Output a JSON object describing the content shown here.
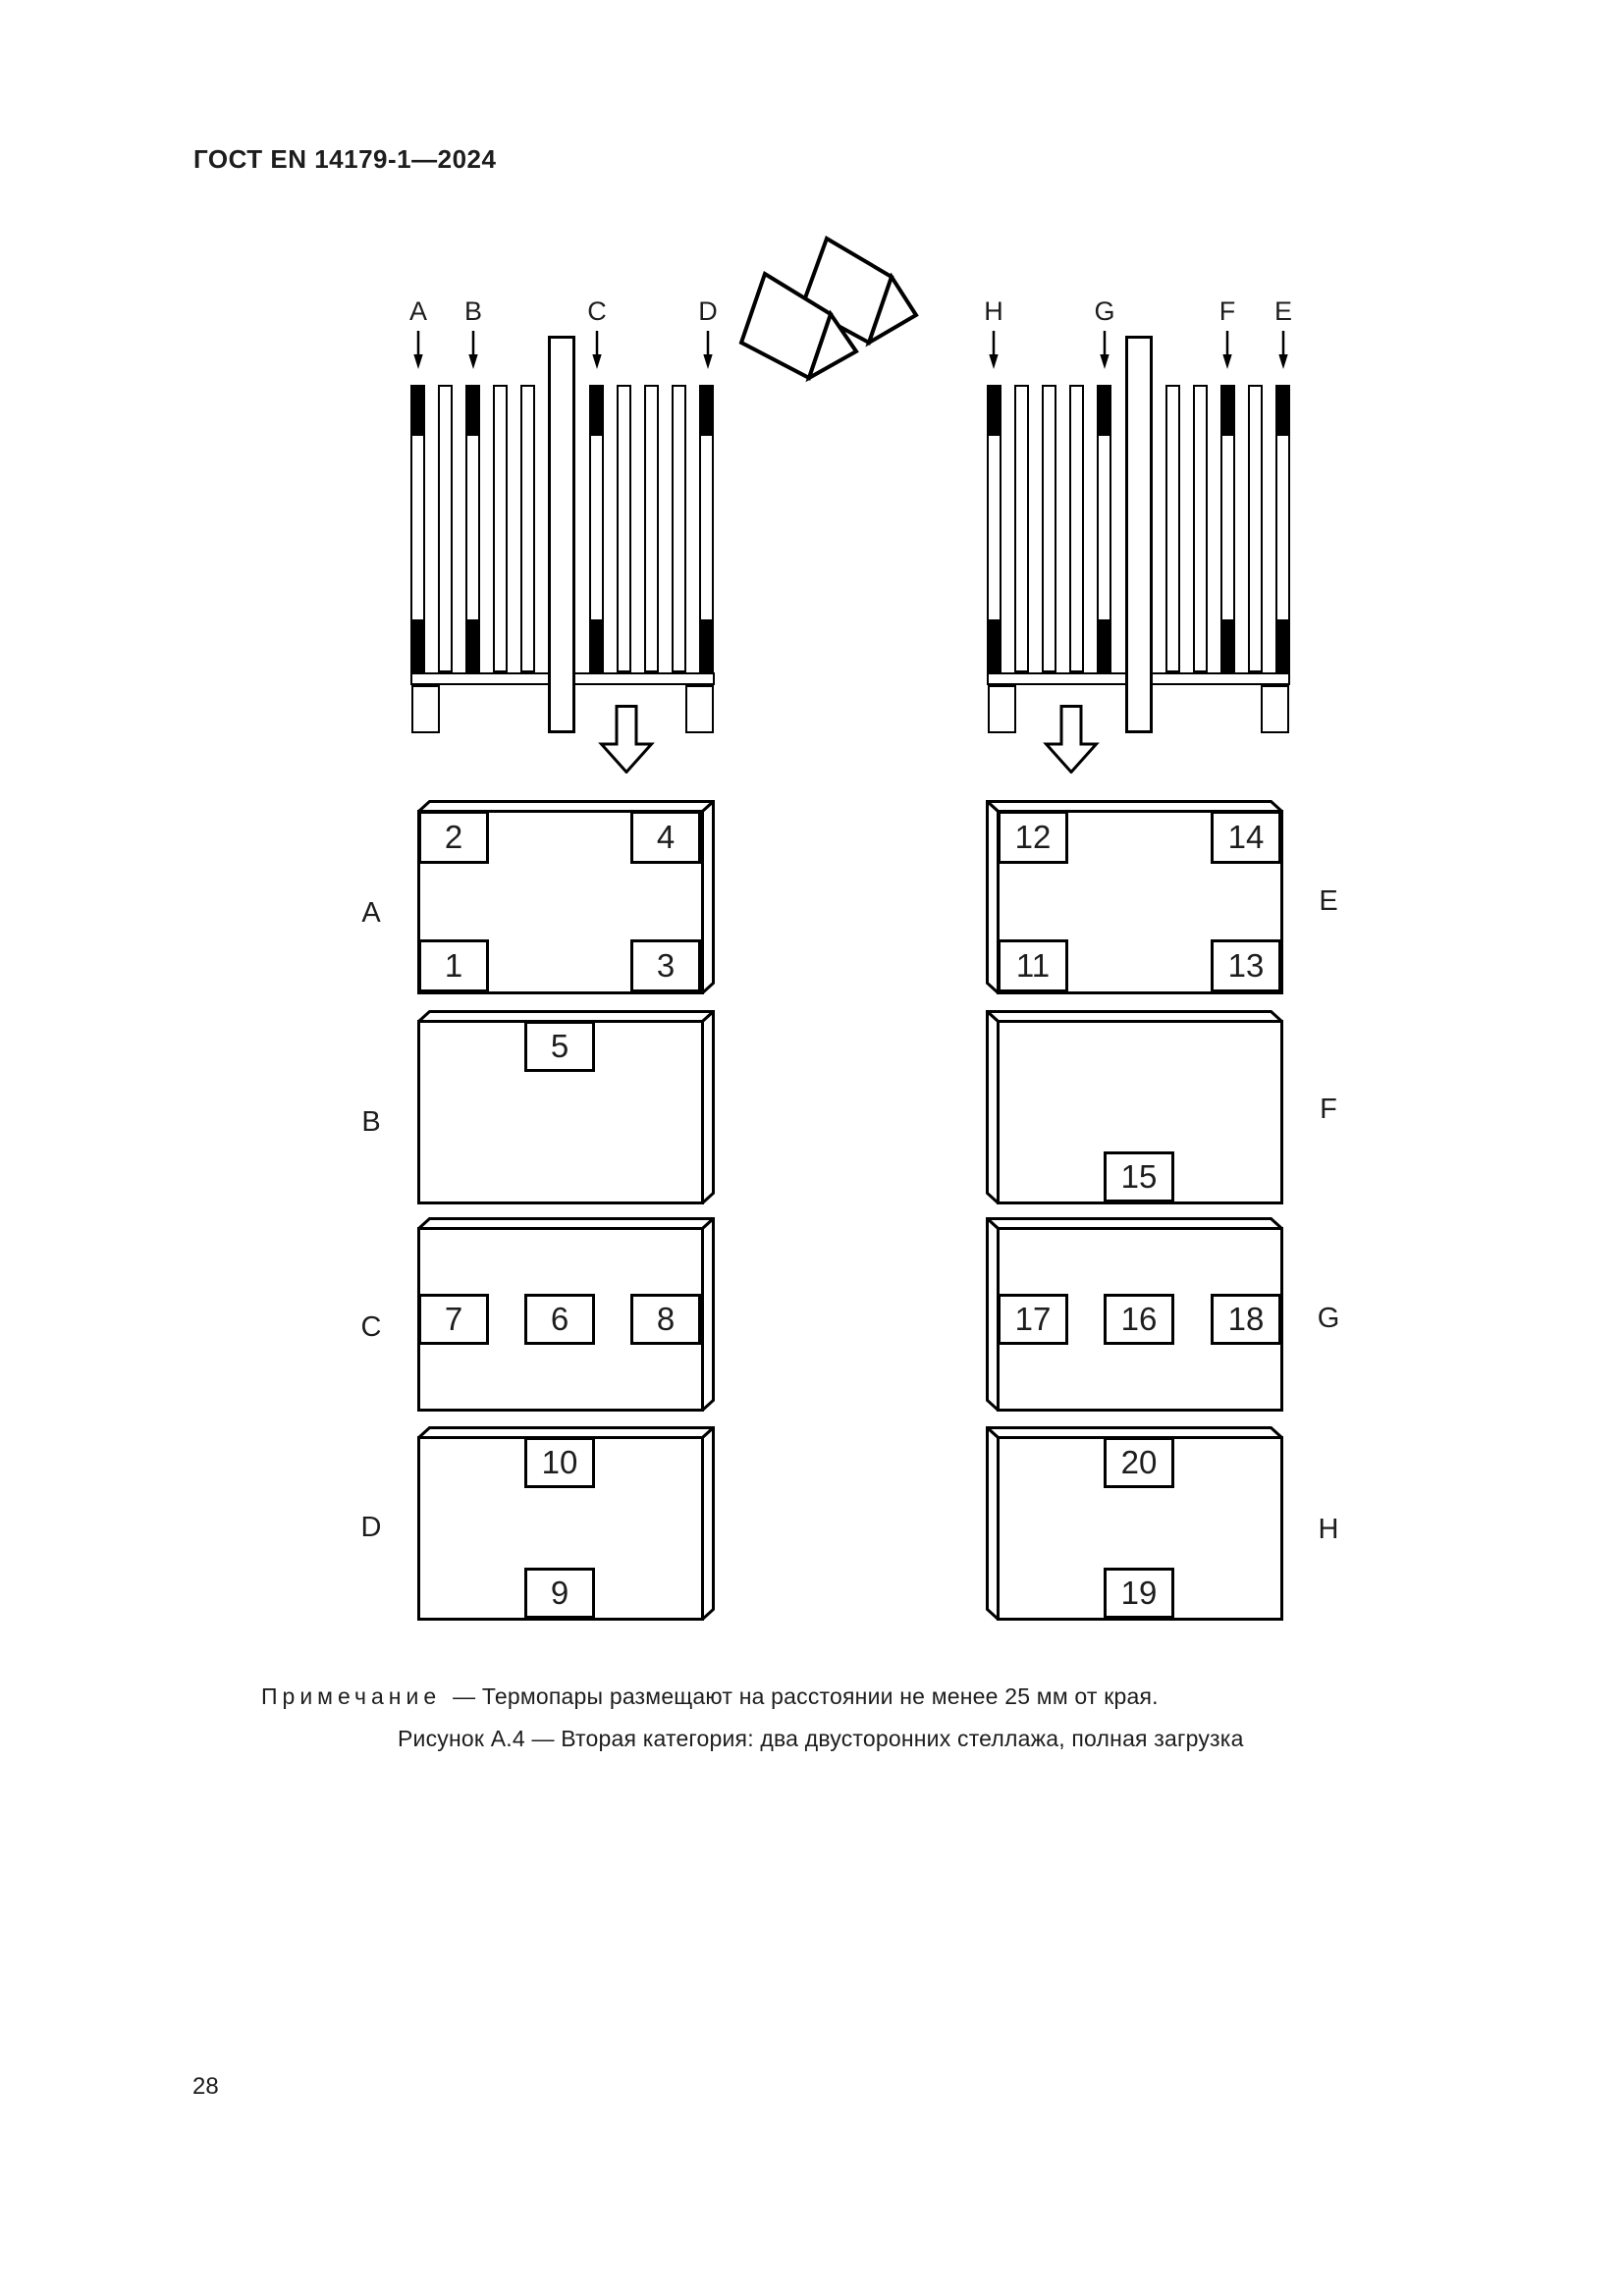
{
  "page": {
    "header": "ГОСТ EN 14179-1—2024",
    "page_number": "28",
    "note": {
      "label": "Примечание",
      "text": "— Термопары размещают на расстоянии не менее 25 мм от края."
    },
    "caption": "Рисунок А.4 — Вторая категория: два двусторонних стеллажа, полная загрузка"
  },
  "racks": {
    "left": {
      "labels": [
        "A",
        "B",
        "C",
        "D"
      ]
    },
    "right": {
      "labels": [
        "H",
        "G",
        "F",
        "E"
      ]
    }
  },
  "boxes": {
    "A": {
      "label": "A",
      "squares": {
        "tl": "2",
        "tr": "4",
        "bl": "1",
        "br": "3"
      }
    },
    "B": {
      "label": "B",
      "squares": {
        "tc": "5"
      }
    },
    "C": {
      "label": "C",
      "squares": {
        "ml": "7",
        "mc": "6",
        "mr": "8"
      }
    },
    "D": {
      "label": "D",
      "squares": {
        "tc": "10",
        "bc": "9"
      }
    },
    "E": {
      "label": "E",
      "squares": {
        "tl": "12",
        "tr": "14",
        "bl": "11",
        "br": "13"
      }
    },
    "F": {
      "label": "F",
      "squares": {
        "bc": "15"
      }
    },
    "G": {
      "label": "G",
      "squares": {
        "ml": "17",
        "mc": "16",
        "mr": "18"
      }
    },
    "H": {
      "label": "H",
      "squares": {
        "tc": "20",
        "bc": "19"
      }
    }
  }
}
